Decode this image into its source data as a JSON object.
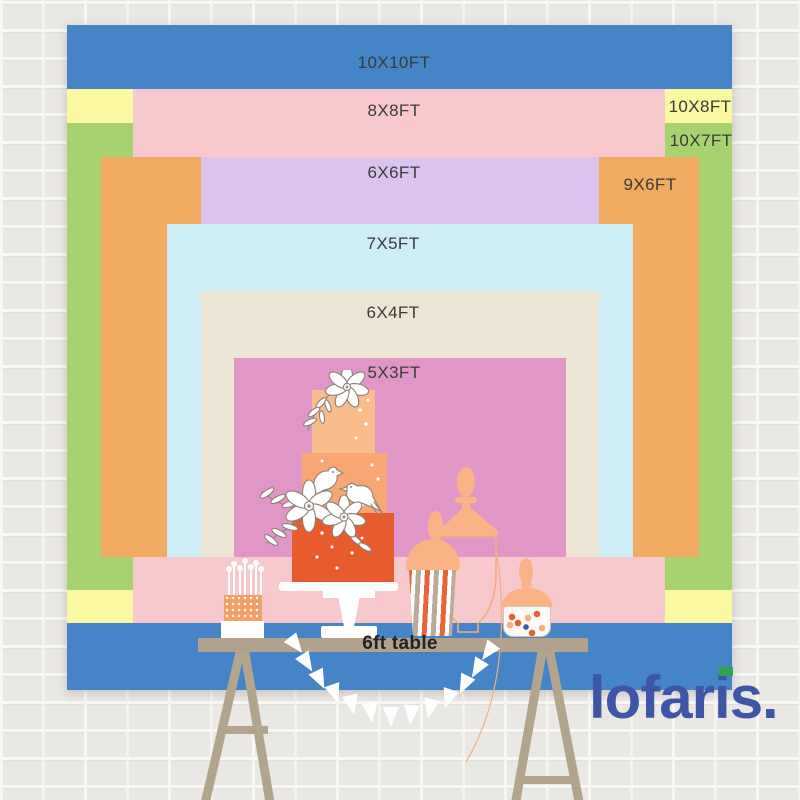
{
  "backdrop_sizes": [
    {
      "label": "10X10FT",
      "color": "#4484c7"
    },
    {
      "label": "10X8FT",
      "color": "#faf8a0"
    },
    {
      "label": "10X7FT",
      "color": "#a6d370"
    },
    {
      "label": "8X8FT",
      "color": "#f7c9cc"
    },
    {
      "label": "9X6FT",
      "color": "#f0ab60"
    },
    {
      "label": "6X6FT",
      "color": "#dcc3ef"
    },
    {
      "label": "7X5FT",
      "color": "#cdeef6"
    },
    {
      "label": "6X4FT",
      "color": "#ece5d3"
    },
    {
      "label": "5X3FT",
      "color": "#e096c6"
    }
  ],
  "table_label": "6ft table",
  "brand": {
    "wordmark": "lofaris.",
    "color": "#3f56a6",
    "accent_color": "#2fa44c"
  }
}
